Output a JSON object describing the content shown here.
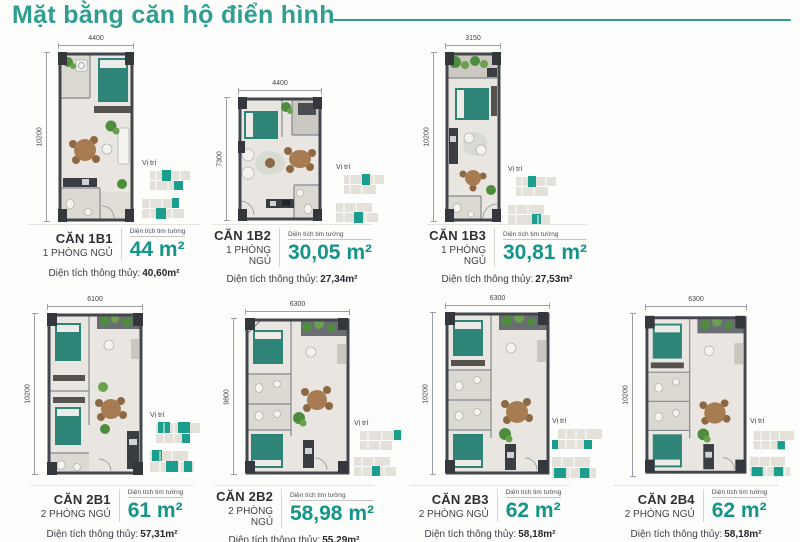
{
  "page": {
    "title": "Mặt bằng căn hộ điển hình",
    "vi_tri_label": "Vị trí",
    "tim_tuong_label": "Diện tích tim tường",
    "thong_thuy_label": "Diện tích thông thủy:"
  },
  "colors": {
    "accent_teal": "#2f9d92",
    "area_teal": "#15948a",
    "wall_dark": "#43474d",
    "bed_teal": "#2e8577"
  },
  "units": [
    {
      "name": "CĂN 1B1",
      "bedrooms": "1 PHÒNG NGỦ",
      "area": "44 m²",
      "clear_area": "40,60m²",
      "width_dim": "4400",
      "height_dim": "10200"
    },
    {
      "name": "CĂN 1B2",
      "bedrooms": "1 PHÒNG NGỦ",
      "area": "30,05 m²",
      "clear_area": "27,34m²",
      "width_dim": "4400",
      "height_dim": "7300"
    },
    {
      "name": "CĂN 1B3",
      "bedrooms": "1 PHÒNG NGỦ",
      "area": "30,81 m²",
      "clear_area": "27,53m²",
      "width_dim": "3150",
      "height_dim": "10200"
    },
    {
      "name": "CĂN 2B1",
      "bedrooms": "2 PHÒNG NGỦ",
      "area": "61 m²",
      "clear_area": "57,31m²",
      "width_dim": "6100",
      "height_dim": "10200"
    },
    {
      "name": "CĂN 2B2",
      "bedrooms": "2 PHÒNG NGỦ",
      "area": "58,98 m²",
      "clear_area": "55,29m²",
      "width_dim": "6300",
      "height_dim": "9800"
    },
    {
      "name": "CĂN 2B3",
      "bedrooms": "2 PHÒNG NGỦ",
      "area": "62 m²",
      "clear_area": "58,18m²",
      "width_dim": "6300",
      "height_dim": "10200"
    },
    {
      "name": "CĂN 2B4",
      "bedrooms": "2 PHÒNG NGỦ",
      "area": "62 m²",
      "clear_area": "58,18m²",
      "width_dim": "6300",
      "height_dim": "10200"
    }
  ]
}
